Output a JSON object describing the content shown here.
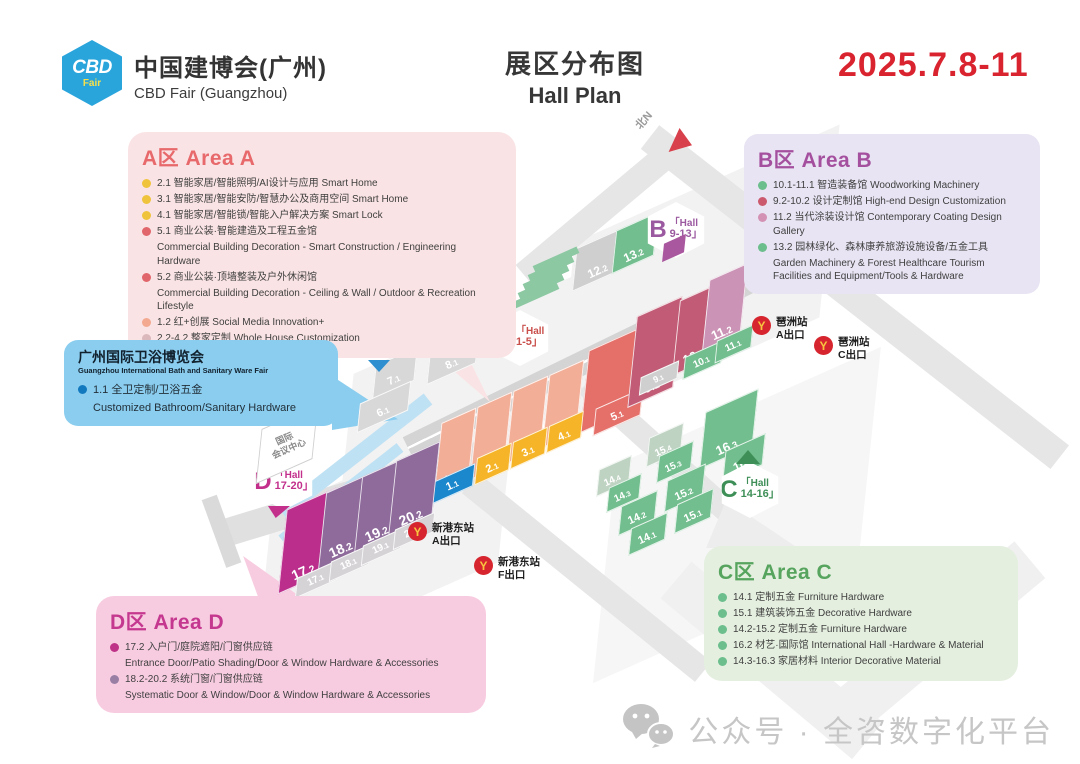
{
  "header": {
    "logo_abbr": "CBD",
    "logo_fair": "Fair",
    "org_cn": "中国建博会(广州)",
    "org_en": "CBD Fair (Guangzhou)",
    "plan_cn": "展区分布图",
    "plan_en": "Hall Plan",
    "dates": "2025.7.8-11",
    "date_color": "#D9232E"
  },
  "areaA": {
    "title": "A区 Area A",
    "items": [
      {
        "dot": "#F0C33C",
        "text": "2.1 智能家居/智能照明/AI设计与应用 Smart Home"
      },
      {
        "dot": "#F0C33C",
        "text": "3.1 智能家居/智能安防/智慧办公及商用空间 Smart Home"
      },
      {
        "dot": "#F0C33C",
        "text": "4.1 智能家居/智能锁/智能入户解决方案 Smart Lock"
      },
      {
        "dot": "#E0666B",
        "text": "5.1 商业公装·智能建造及工程五金馆",
        "sub": "Commercial Building Decoration - Smart Construction / Engineering Hardware"
      },
      {
        "dot": "#E0666B",
        "text": "5.2 商业公装·顶墙整装及户外休闲馆",
        "sub": "Commercial Building Decoration - Ceiling & Wall / Outdoor & Recreation Lifestyle"
      },
      {
        "dot": "#F2A98F",
        "text": "1.2 红+创展 Social Media Innovation+"
      },
      {
        "dot": "#DBB8BC",
        "text": "2.2-4.2 整家定制 Whole House Customization"
      }
    ]
  },
  "areaB": {
    "title": "B区 Area B",
    "items": [
      {
        "dot": "#6CBE8C",
        "text": "10.1-11.1 智造装备馆 Woodworking Machinery"
      },
      {
        "dot": "#CC5A6E",
        "text": "9.2-10.2 设计定制馆 High-end Design Customization"
      },
      {
        "dot": "#D392B3",
        "text": "11.2 当代涂装设计馆 Contemporary Coating Design Gallery"
      },
      {
        "dot": "#6CBE8C",
        "text": "13.2 园林绿化、森林康养旅游设施设备/五金工具",
        "sub": "Garden Machinery & Forest Healthcare Tourism Facilities and Equipment/Tools & Hardware"
      }
    ]
  },
  "areaC": {
    "title": "C区 Area C",
    "items": [
      {
        "dot": "#6CBE8C",
        "text": "14.1 定制五金 Furniture Hardware"
      },
      {
        "dot": "#6CBE8C",
        "text": "15.1 建筑装饰五金 Decorative Hardware"
      },
      {
        "dot": "#6CBE8C",
        "text": "14.2-15.2 定制五金 Furniture Hardware"
      },
      {
        "dot": "#6CBE8C",
        "text": "16.2 材艺·国际馆 International Hall -Hardware & Material"
      },
      {
        "dot": "#6CBE8C",
        "text": "14.3-16.3 家居材料 Interior Decorative Material"
      }
    ]
  },
  "areaD": {
    "title": "D区 Area D",
    "items": [
      {
        "dot": "#BE3387",
        "text": "17.2 入户门/庭院遮阳/门窗供应链",
        "sub": "Entrance Door/Patio Shading/Door & Window Hardware & Accessories"
      },
      {
        "dot": "#9A7FA5",
        "text": "18.2-20.2 系统门窗/门窗供应链",
        "sub": "Systematic Door & Window/Door & Window Hardware & Accessories"
      }
    ]
  },
  "bath": {
    "title": "广州国际卫浴博览会",
    "subtitle": "Guangzhou International Bath and Sanitary Ware Fair",
    "dot": "#1279BE",
    "item": "1.1 全卫定制/卫浴五金",
    "item_sub": "Customized Bathroom/Sanitary Hardware"
  },
  "map": {
    "north_label": "北N",
    "metro_icon": "Y",
    "conference_center": {
      "line1": "国际",
      "line2": "会议中心"
    },
    "colors": {
      "salmon": "#F3AE97",
      "yellow": "#F6B528",
      "coral": "#E57069",
      "blue": "#1B87CC",
      "gray": "#D8D8D8",
      "rose": "#C25C76",
      "pinkB": "#CB93B5",
      "green": "#72BE8E",
      "lightgreen": "#BFD3C3",
      "grayB": "#CFCFCF",
      "magenta": "#BB2E8C",
      "purple": "#8E6B9B",
      "grayD": "#D6D3D7"
    },
    "halls": [
      {
        "label": "7.1",
        "c": "gray",
        "x": 372,
        "y": 358,
        "w": 46,
        "h": 30,
        "fs": 11
      },
      {
        "label": "8.1",
        "c": "gray",
        "x": 426,
        "y": 342,
        "w": 54,
        "h": 30,
        "fs": 11
      },
      {
        "label": "6.1",
        "c": "gray",
        "x": 356,
        "y": 394,
        "w": 56,
        "h": 26,
        "fs": 11
      },
      {
        "label": "1.2",
        "c": "salmon",
        "x": 436,
        "y": 420,
        "w": 38,
        "h": 64,
        "fs": 13
      },
      {
        "label": "2.2",
        "c": "salmon",
        "x": 472,
        "y": 404,
        "w": 38,
        "h": 64,
        "fs": 13
      },
      {
        "label": "3.2",
        "c": "salmon",
        "x": 508,
        "y": 388,
        "w": 38,
        "h": 64,
        "fs": 13
      },
      {
        "label": "4.2",
        "c": "salmon",
        "x": 544,
        "y": 372,
        "w": 38,
        "h": 64,
        "fs": 13
      },
      {
        "label": "5.2",
        "c": "coral",
        "x": 582,
        "y": 344,
        "w": 58,
        "h": 72,
        "fs": 14
      },
      {
        "label": "5.1",
        "c": "coral",
        "x": 592,
        "y": 400,
        "w": 52,
        "h": 24,
        "fs": 11
      },
      {
        "label": "2.1",
        "c": "yellow",
        "x": 474,
        "y": 452,
        "w": 38,
        "h": 24,
        "fs": 11
      },
      {
        "label": "3.1",
        "c": "yellow",
        "x": 510,
        "y": 436,
        "w": 38,
        "h": 24,
        "fs": 11
      },
      {
        "label": "4.1",
        "c": "yellow",
        "x": 546,
        "y": 420,
        "w": 38,
        "h": 24,
        "fs": 11
      },
      {
        "label": "1.1",
        "c": "blue",
        "x": 430,
        "y": 474,
        "w": 46,
        "h": 20,
        "fs": 11
      },
      {
        "label": "12.2",
        "c": "grayB",
        "x": 572,
        "y": 240,
        "w": 54,
        "h": 38,
        "fs": 12
      },
      {
        "label": "13.2",
        "c": "green",
        "x": 612,
        "y": 224,
        "w": 46,
        "h": 38,
        "fs": 12
      },
      {
        "label": "9.2",
        "c": "rose",
        "x": 630,
        "y": 312,
        "w": 50,
        "h": 80,
        "fs": 14
      },
      {
        "label": "10.2",
        "c": "rose",
        "x": 674,
        "y": 296,
        "w": 46,
        "h": 66,
        "fs": 13
      },
      {
        "label": "11.2",
        "c": "pinkB",
        "x": 704,
        "y": 276,
        "w": 42,
        "h": 62,
        "fs": 13
      },
      {
        "label": "10.1",
        "c": "green",
        "x": 682,
        "y": 350,
        "w": 42,
        "h": 20,
        "fs": 10
      },
      {
        "label": "11.1",
        "c": "green",
        "x": 714,
        "y": 334,
        "w": 40,
        "h": 20,
        "fs": 10
      },
      {
        "label": "9.1",
        "c": "grayB",
        "x": 638,
        "y": 370,
        "w": 42,
        "h": 16,
        "fs": 9
      },
      {
        "label": "16.3",
        "c": "green",
        "x": 700,
        "y": 404,
        "w": 58,
        "h": 50,
        "fs": 13
      },
      {
        "label": "16.2",
        "c": "green",
        "x": 722,
        "y": 444,
        "w": 44,
        "h": 28,
        "fs": 12
      },
      {
        "label": "15.4",
        "c": "lightgreen",
        "x": 646,
        "y": 432,
        "w": 38,
        "h": 26,
        "fs": 10
      },
      {
        "label": "15.3",
        "c": "green",
        "x": 656,
        "y": 450,
        "w": 38,
        "h": 24,
        "fs": 10
      },
      {
        "label": "15.2",
        "c": "green",
        "x": 664,
        "y": 474,
        "w": 42,
        "h": 28,
        "fs": 11
      },
      {
        "label": "15.1",
        "c": "green",
        "x": 674,
        "y": 498,
        "w": 40,
        "h": 26,
        "fs": 11
      },
      {
        "label": "14.4",
        "c": "lightgreen",
        "x": 596,
        "y": 464,
        "w": 36,
        "h": 24,
        "fs": 10
      },
      {
        "label": "14.3",
        "c": "green",
        "x": 606,
        "y": 482,
        "w": 36,
        "h": 22,
        "fs": 10
      },
      {
        "label": "14.2",
        "c": "green",
        "x": 618,
        "y": 500,
        "w": 40,
        "h": 26,
        "fs": 11
      },
      {
        "label": "14.1",
        "c": "green",
        "x": 628,
        "y": 522,
        "w": 40,
        "h": 24,
        "fs": 11
      },
      {
        "label": "17.2",
        "c": "magenta",
        "x": 280,
        "y": 504,
        "w": 54,
        "h": 74,
        "fs": 14
      },
      {
        "label": "18.2",
        "c": "purple",
        "x": 320,
        "y": 488,
        "w": 48,
        "h": 68,
        "fs": 14
      },
      {
        "label": "19.2",
        "c": "purple",
        "x": 356,
        "y": 472,
        "w": 48,
        "h": 68,
        "fs": 14
      },
      {
        "label": "20.2",
        "c": "purple",
        "x": 390,
        "y": 456,
        "w": 48,
        "h": 68,
        "fs": 14
      },
      {
        "label": "17.1",
        "c": "grayD",
        "x": 294,
        "y": 570,
        "w": 46,
        "h": 18,
        "fs": 10
      },
      {
        "label": "18.1",
        "c": "grayD",
        "x": 328,
        "y": 554,
        "w": 44,
        "h": 18,
        "fs": 10
      },
      {
        "label": "19.1",
        "c": "grayD",
        "x": 360,
        "y": 538,
        "w": 44,
        "h": 18,
        "fs": 10
      },
      {
        "label": "20.1",
        "c": "grayD",
        "x": 392,
        "y": 522,
        "w": 44,
        "h": 18,
        "fs": 10
      }
    ],
    "hexes": [
      {
        "letter": "A",
        "line1": "「Hall",
        "line2": "6-8」",
        "color": "#2E8FD0",
        "x": 348,
        "y": 308
      },
      {
        "letter": "A",
        "line1": "「Hall",
        "line2": "1-5」",
        "color": "#C94F4B",
        "x": 490,
        "y": 310
      },
      {
        "letter": "B",
        "line1": "「Hall",
        "line2": "9-13」",
        "color": "#9B59A0",
        "x": 646,
        "y": 202
      },
      {
        "letter": "C",
        "line1": "「Hall",
        "line2": "14-16」",
        "color": "#3E8F57",
        "x": 720,
        "y": 462
      },
      {
        "letter": "D",
        "line1": "「Hall",
        "line2": "17-20」",
        "color": "#C2308C",
        "x": 254,
        "y": 454
      }
    ],
    "stations": [
      {
        "name": "琶洲站",
        "exit": "A出口",
        "x": 752,
        "y": 316
      },
      {
        "name": "琶洲站",
        "exit": "C出口",
        "x": 814,
        "y": 336
      },
      {
        "name": "新港东站",
        "exit": "A出口",
        "x": 408,
        "y": 522
      },
      {
        "name": "新港东站",
        "exit": "F出口",
        "x": 474,
        "y": 556
      }
    ]
  },
  "watermark": {
    "text": "公众号 · 全咨数字化平台"
  }
}
